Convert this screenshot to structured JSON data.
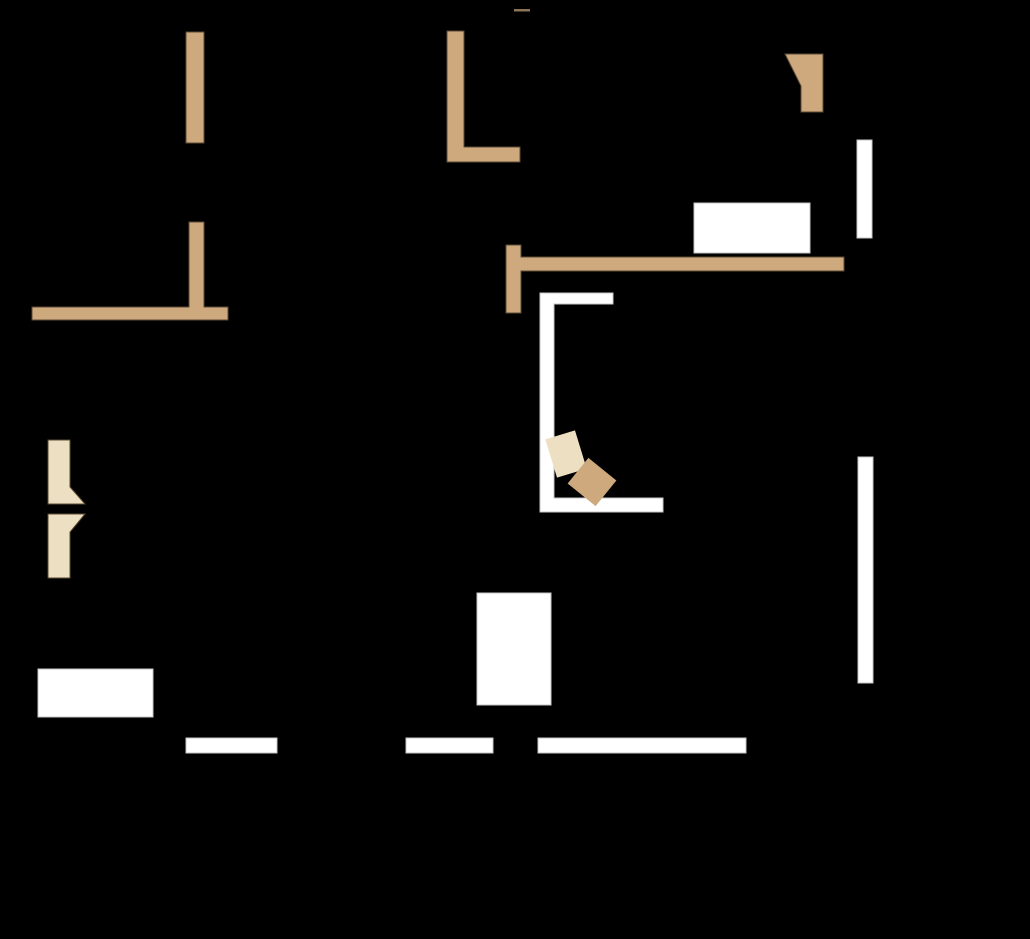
{
  "canvas": {
    "width": 1030,
    "height": 939,
    "background": "#000000"
  },
  "palette": {
    "black": "#000000",
    "tan": "#CDA97D",
    "cream": "#EDE0C2",
    "white": "#FFFFFF",
    "tan_stroke": "#5C4B33",
    "white_stroke": "#C6C6C6",
    "dark_line": "#8A7356"
  },
  "shapes": [
    {
      "name": "brown-thin-line-top-center",
      "type": "rect",
      "x": 514,
      "y": 9,
      "w": 16,
      "h": 2.5,
      "fill": "dark_line",
      "stroke": null
    },
    {
      "name": "tan-wall-bar-top-left",
      "type": "rect",
      "x": 186,
      "y": 32,
      "w": 18,
      "h": 111,
      "fill": "tan",
      "stroke": "tan_stroke"
    },
    {
      "name": "tan-wall-corner-top-center",
      "type": "polygon",
      "points": "447,31 464,31 464,147 520,147 520,162 447,162",
      "fill": "tan",
      "stroke": "tan_stroke"
    },
    {
      "name": "tan-flag-top-right",
      "type": "polygon",
      "points": "785,54 823,54 823,112 801,112 801,86",
      "fill": "tan",
      "stroke": "tan_stroke"
    },
    {
      "name": "tan-tee-wall-left",
      "type": "polygon",
      "points": "189,222 204,222 204,307 228,307 228,320 32,320 32,307 189,307",
      "fill": "tan",
      "stroke": "tan_stroke"
    },
    {
      "name": "tan-shelf-wall-center",
      "type": "polygon",
      "points": "506,245 521,245 521,257 844,257 844,271 521,271 521,313 506,313",
      "fill": "tan",
      "stroke": "tan_stroke"
    },
    {
      "name": "cream-notched-bar-upper-left",
      "type": "polygon",
      "points": "48,440 70,440 70,487 85,504 48,504",
      "fill": "cream",
      "stroke": "tan_stroke"
    },
    {
      "name": "cream-notched-bar-lower-left",
      "type": "polygon",
      "points": "48,514 85,514 70,532 70,578 48,578",
      "fill": "cream",
      "stroke": "tan_stroke"
    },
    {
      "name": "white-wall-bar-top-right",
      "type": "rect",
      "x": 857,
      "y": 140,
      "w": 15,
      "h": 98,
      "fill": "white",
      "stroke": "white_stroke"
    },
    {
      "name": "white-block-top-right",
      "type": "rect",
      "x": 694,
      "y": 203,
      "w": 116,
      "h": 50,
      "fill": "white",
      "stroke": "white_stroke"
    },
    {
      "name": "white-u-wall-center",
      "type": "polygon",
      "points": "540,293 613,293 613,304 554,304 554,498 663,498 663,512 540,512",
      "fill": "white",
      "stroke": "white_stroke"
    },
    {
      "name": "white-wall-bar-right-middle",
      "type": "rect",
      "x": 858,
      "y": 457,
      "w": 15,
      "h": 226,
      "fill": "white",
      "stroke": "white_stroke"
    },
    {
      "name": "white-block-bottom-left",
      "type": "rect",
      "x": 38,
      "y": 669,
      "w": 115,
      "h": 48,
      "fill": "white",
      "stroke": "white_stroke"
    },
    {
      "name": "white-block-bottom-center",
      "type": "rect",
      "x": 477,
      "y": 593,
      "w": 74,
      "h": 112,
      "fill": "white",
      "stroke": "white_stroke"
    },
    {
      "name": "white-wall-bar-bottom-left",
      "type": "rect",
      "x": 186,
      "y": 738,
      "w": 91,
      "h": 15,
      "fill": "white",
      "stroke": "white_stroke"
    },
    {
      "name": "white-wall-bar-bottom-middle",
      "type": "rect",
      "x": 406,
      "y": 738,
      "w": 87,
      "h": 15,
      "fill": "white",
      "stroke": "white_stroke"
    },
    {
      "name": "white-wall-bar-bottom-right",
      "type": "rect",
      "x": 538,
      "y": 738,
      "w": 208,
      "h": 15,
      "fill": "white",
      "stroke": "white_stroke"
    },
    {
      "name": "cream-box-rotated-center",
      "type": "rotrect",
      "cx": 566,
      "cy": 454,
      "w": 31,
      "h": 40,
      "angle": -17,
      "fill": "cream",
      "stroke": null
    },
    {
      "name": "tan-box-rotated-center",
      "type": "rotrect",
      "cx": 592,
      "cy": 482,
      "w": 36,
      "h": 33,
      "angle": 39,
      "fill": "tan",
      "stroke": null
    }
  ]
}
